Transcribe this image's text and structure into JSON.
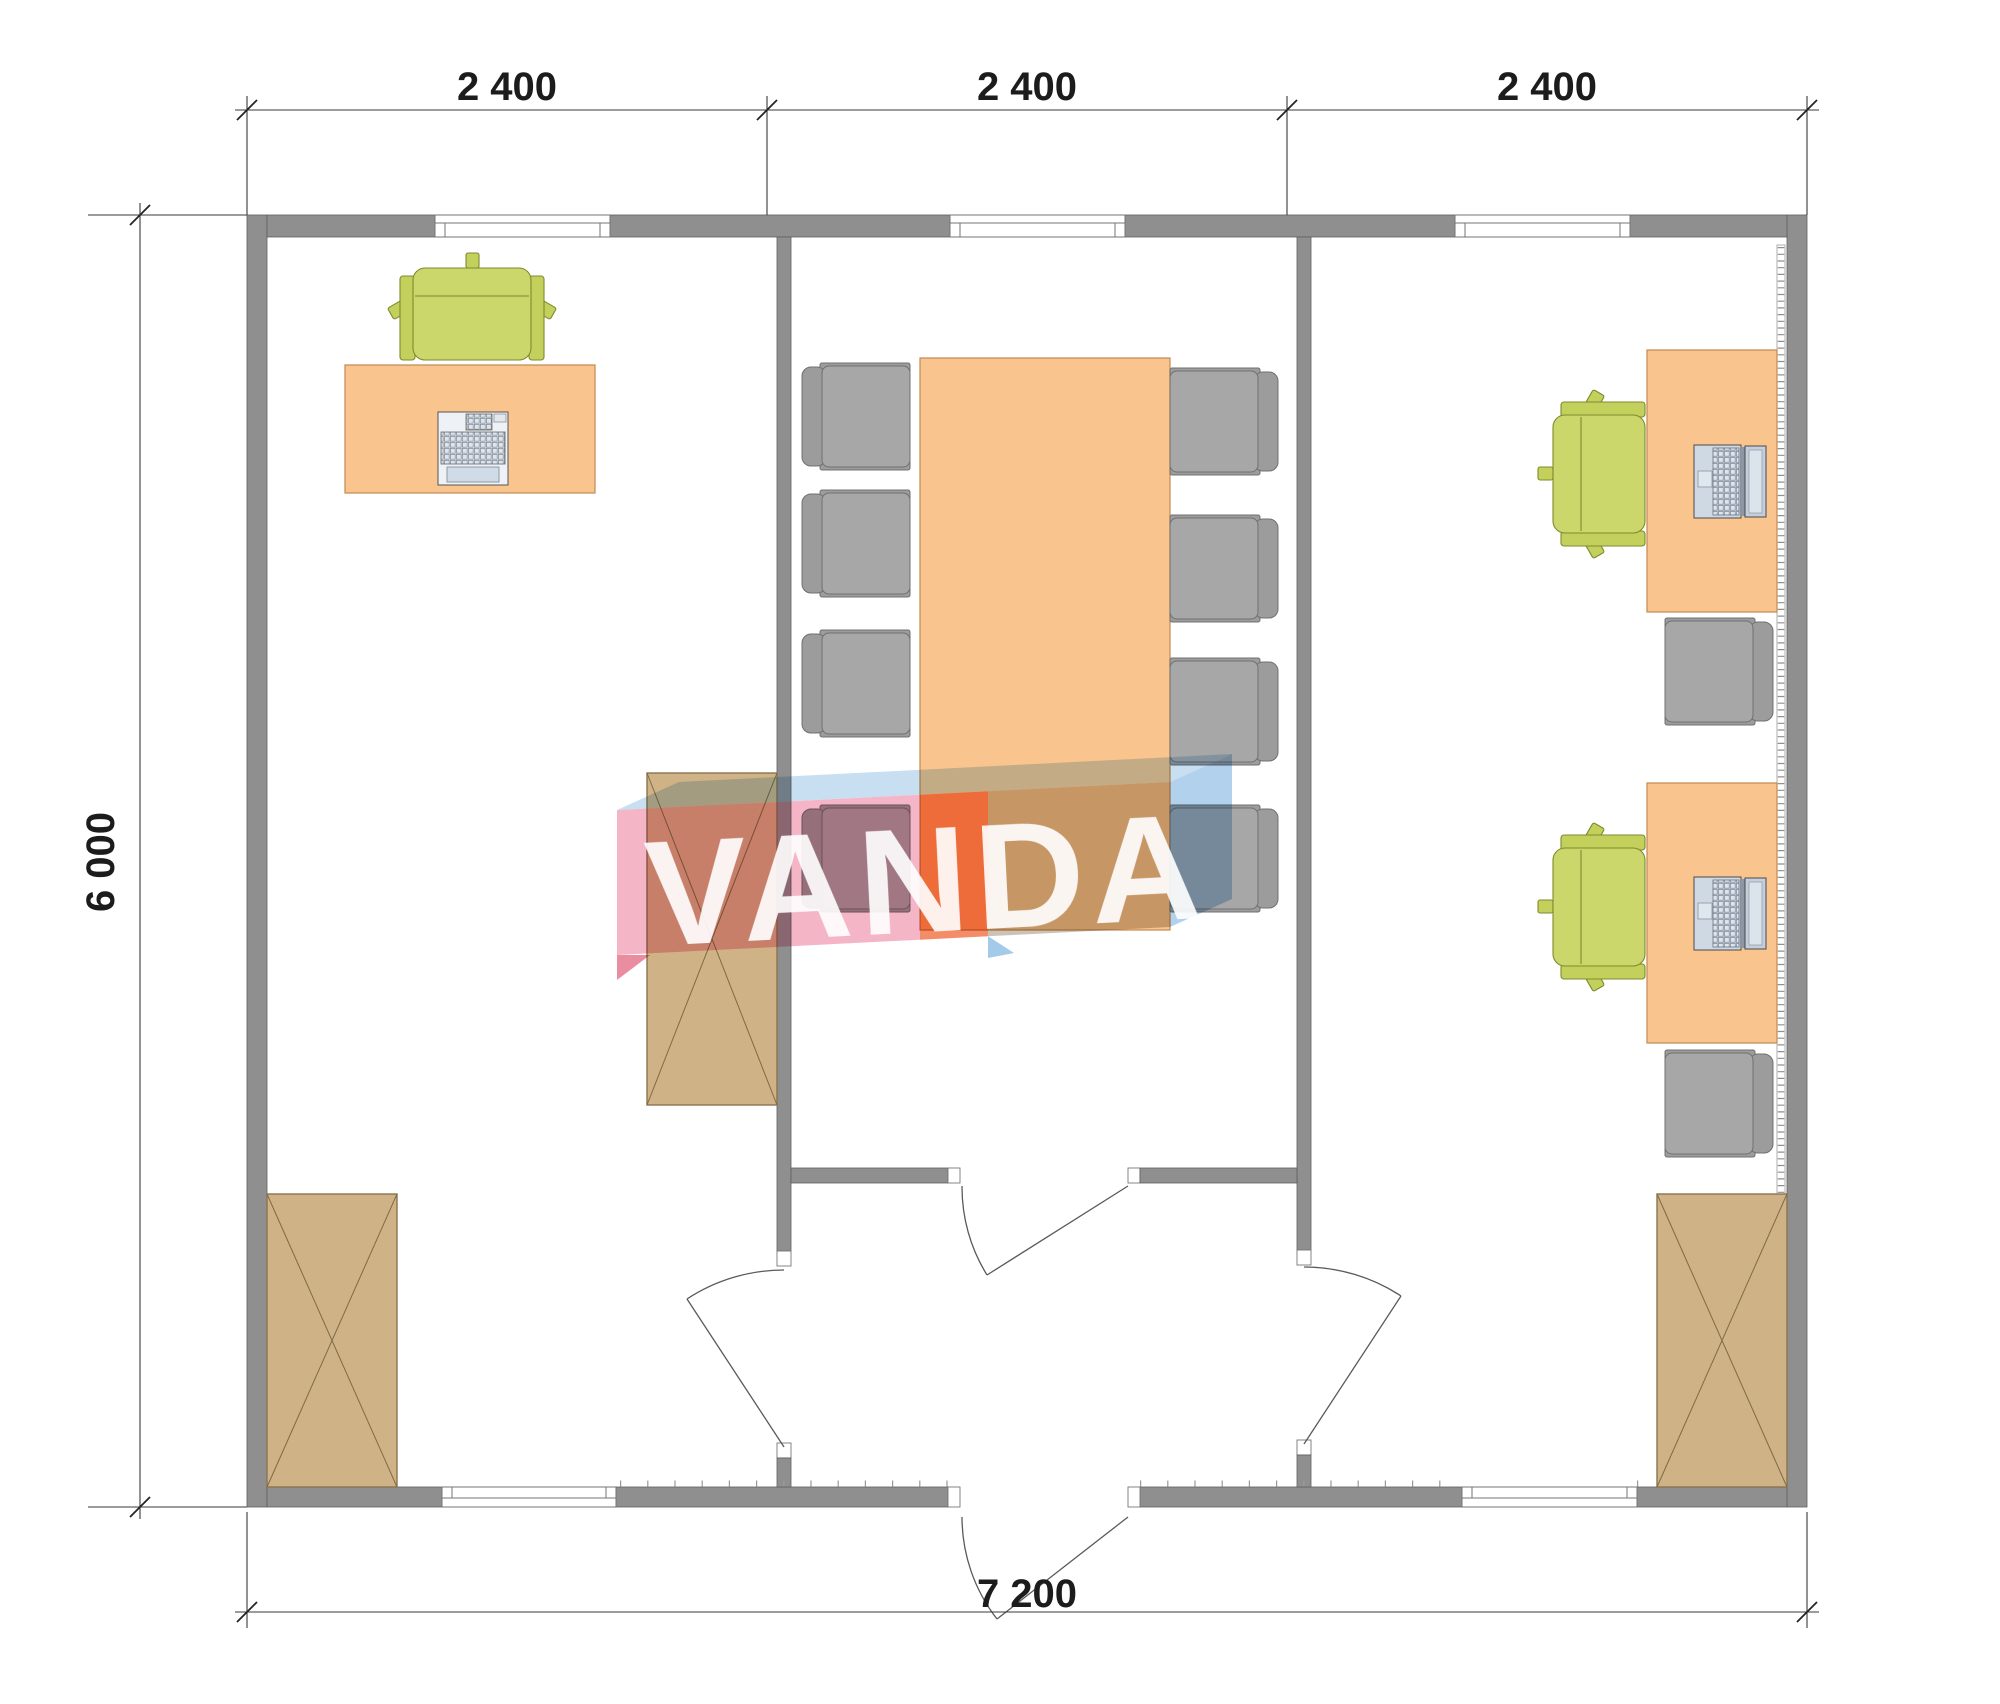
{
  "dimensions": {
    "top": [
      "2 400",
      "2 400",
      "2 400"
    ],
    "left": "6 000",
    "bottom": "7 200"
  },
  "watermark": {
    "text": "VANDA"
  },
  "colors": {
    "wall": "#8f8f8f",
    "desk_and_table": "#f9c48e",
    "cabinet": "#d0b287",
    "chair_gray": "#a7a7a7",
    "chair_green": "#ccd76b",
    "device_blue_gray": "#cfd9e4",
    "logo_pink": "#f2a9bd",
    "logo_salmon": "#f28057",
    "logo_light_blue": "#c2dcef",
    "dimension_text": "#1c1c1c"
  }
}
